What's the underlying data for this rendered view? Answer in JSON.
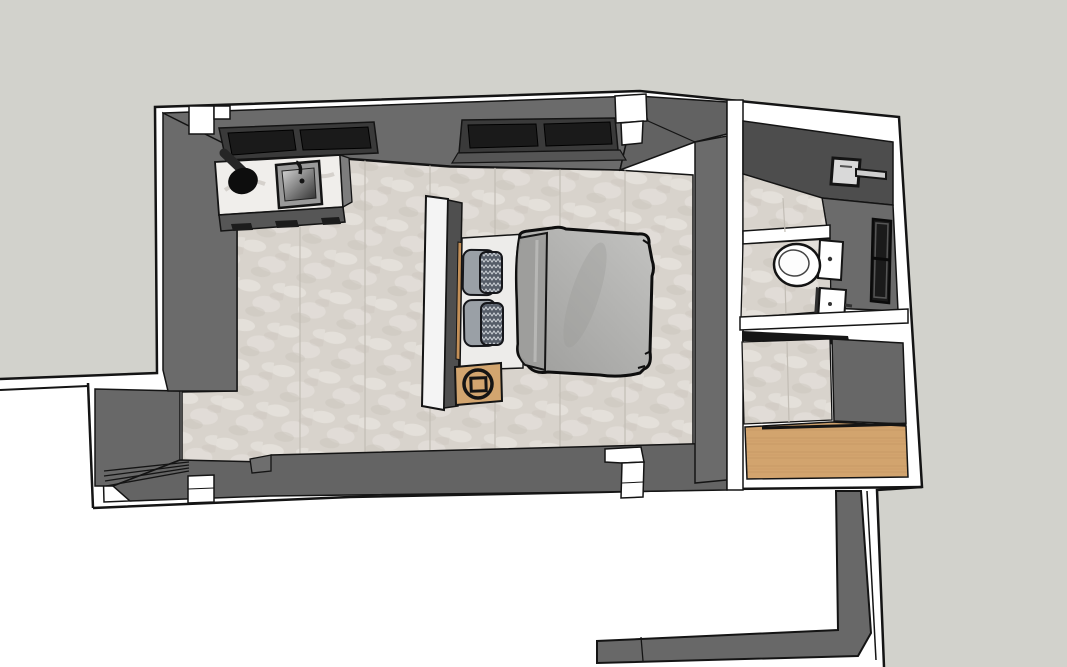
{
  "scene": {
    "title": "3D floor plan render: bedroom suite with ensuite bathroom, top-down view",
    "style": "sketch line render, white cut walls with black outlines",
    "view": "overhead axonometric"
  },
  "rooms": {
    "bedroom": {
      "label": "bedroom"
    },
    "bathroom": {
      "label": "bathroom"
    },
    "closet": {
      "label": "closet entry with wood floor"
    },
    "annex": {
      "label": "adjacent room (partially visible)"
    },
    "wing": {
      "label": "lower-left wing with louver steps"
    }
  },
  "objects": {
    "counter": "kitchenette counter with marble top, basin and square sink",
    "bed": "double bed with headboard, two pillow stacks, gray duvet",
    "nightstand": "wooden bedside table with round logo",
    "toilet": "toilet with tank",
    "vanity": "small white vanity cabinet",
    "shower": "wall-mounted shower arm",
    "windows": "dark inset windows in top and right walls"
  },
  "colors": {
    "ground": "#d2d2cc",
    "canvas": "#ffffff",
    "line": "#141414",
    "wallFace": "#6b6b6b",
    "wallFace2": "#646464",
    "wallDark": "#4d4d4d",
    "chamfer": "#626262",
    "cut": "#ffffff",
    "floorMarble": "#d8d3cc",
    "floorMarbleLight": "#e7e3dd",
    "floorMarbleDark": "#c9c3bb",
    "floorSeam": "#c2bdb5",
    "floorWood": "#d2a46e",
    "woodStreak": "#c2925e",
    "counterMarble": "#f0eeeb",
    "counterFront": "#565656",
    "windowFrame": "#3a3a3a",
    "windowGlass": "#1a1a1a",
    "headboard": "#f4f4f4",
    "headboardPanel": "#4f4f4f",
    "woodTrim": "#c49058",
    "sheet": "#edecea",
    "pillowPlain": "#9aa0a6",
    "pillowPattern": "#565d68",
    "pillowZigzag": "#cfd3d8",
    "duvetLight": "#c3c3c1",
    "duvetDark": "#9d9d9b",
    "duvetFold": "#9e9e9c",
    "nightstand": "#d2a56f",
    "metal": "#d9d9d9",
    "toilet": "#ffffff"
  }
}
